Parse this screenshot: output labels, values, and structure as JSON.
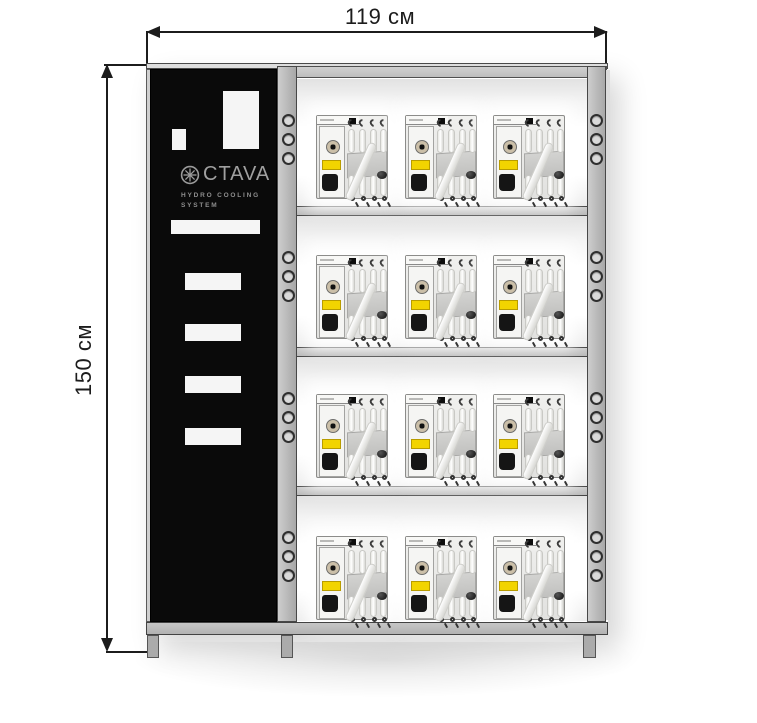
{
  "figure": {
    "width_dimension": "119 см",
    "height_dimension": "150 см"
  },
  "cabinet": {
    "logo": {
      "icon": "impeller-icon",
      "brand_text": "CTAVA",
      "subtitle_line1": "HYDRO COOLING",
      "subtitle_line2": "SYSTEM"
    },
    "rack": {
      "shelf_count": 4,
      "devices_per_shelf": 3,
      "device_total": 12
    },
    "colors": {
      "frame_gray": "#bdbdbd",
      "panel_black": "#0a0a0a",
      "device_label_yellow": "#f2d400",
      "dimension_line": "#1c1c1c",
      "background": "#ffffff"
    }
  }
}
